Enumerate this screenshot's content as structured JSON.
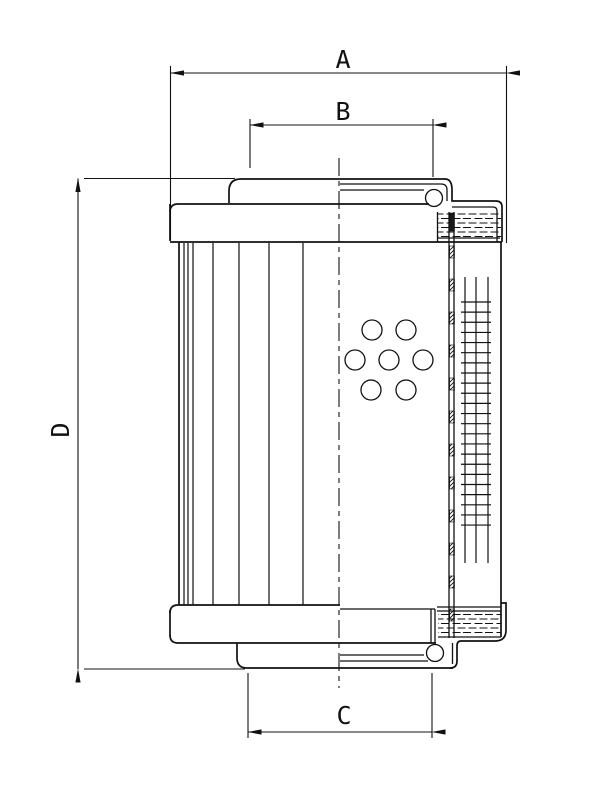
{
  "page": {
    "background": "#ffffff",
    "line_color": "#111111"
  },
  "dimensions": {
    "a": "A",
    "b": "B",
    "c": "C",
    "d": "D"
  }
}
